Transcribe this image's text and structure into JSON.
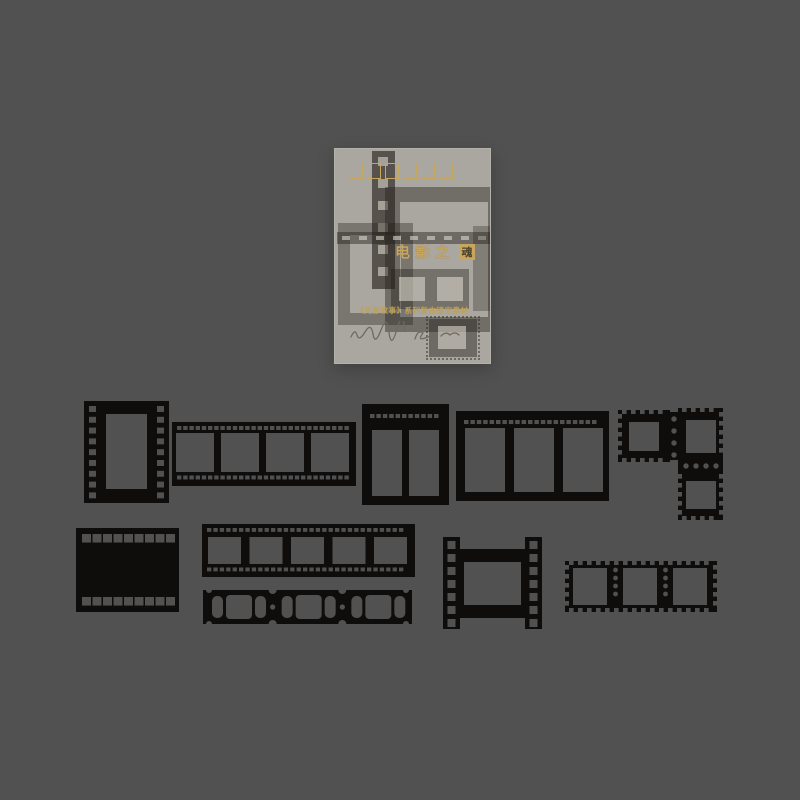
{
  "scene": {
    "background_color": "#515151",
    "ink_color": "#0f0d0b",
    "bag_color": "rgba(224,219,208,0.62)",
    "ghost_ink": "35,31,26",
    "ghost_window": "rgba(230,225,214,0.55)"
  },
  "package": {
    "title_prefix": "电影之",
    "seal_char": "魂",
    "subtitle": "《光影故事》系列复古镂空素材",
    "deco_square_count": 6,
    "gold_color": "#c8a65b",
    "seal_text_color": "#4a4030",
    "subtitle_color": "#bfa055",
    "signature_color": "#6e6a62",
    "ghosts": [
      {
        "kind": "strip-v",
        "x": 37,
        "y": 2,
        "w": 23,
        "h": 138,
        "a": 0.62,
        "holes": 6
      },
      {
        "kind": "frame",
        "x": 50,
        "y": 38,
        "w": 88,
        "h": 115,
        "b": 15,
        "a": 0.42
      },
      {
        "kind": "frame",
        "x": 3,
        "y": 74,
        "w": 51,
        "h": 78,
        "b": 12,
        "a": 0.36
      },
      {
        "kind": "band",
        "x": 2,
        "y": 83,
        "w": 153,
        "h": 12,
        "a": 0.45,
        "dashes": 9
      },
      {
        "kind": "solid",
        "x": 56,
        "y": 120,
        "w": 78,
        "h": 40,
        "a": 0.4,
        "wins": 2
      },
      {
        "kind": "solid",
        "x": 138,
        "y": 77,
        "w": 17,
        "h": 85,
        "a": 0.3,
        "wins": 0
      },
      {
        "kind": "stampghost",
        "x": 94,
        "y": 170,
        "w": 48,
        "h": 38,
        "a": 0.45
      }
    ]
  },
  "pieces": [
    {
      "id": "film-frame-vertical",
      "type": "vframe",
      "x": 84,
      "y": 401,
      "w": 85,
      "h": 102,
      "hole": [
        22,
        13,
        41,
        75
      ],
      "perf": {
        "count": 9,
        "size": 7,
        "inset": 5,
        "top": 5,
        "step": 10.8
      }
    },
    {
      "id": "filmstrip-4-frames",
      "type": "hstrip",
      "x": 172,
      "y": 422,
      "w": 184,
      "h": 64,
      "frames": {
        "count": 4,
        "ml": 4,
        "w": 38,
        "gap": 7,
        "top": 11,
        "h": 39
      },
      "perf": {
        "size": 4.4,
        "step": 6.2,
        "ml": 5,
        "topOff": 4,
        "botOff": 53.5
      }
    },
    {
      "id": "film-window-frame-2",
      "type": "windowframe",
      "x": 362,
      "y": 404,
      "w": 87,
      "h": 101,
      "windows": {
        "count": 2,
        "ml": 10,
        "w": 30,
        "gap": 7,
        "top": 26,
        "h": 66
      },
      "perf": {
        "size": 4.5,
        "step": 6.4,
        "ml": 8,
        "yOff": 10
      }
    },
    {
      "id": "film-window-frame-3",
      "type": "windowframe",
      "x": 456,
      "y": 411,
      "w": 153,
      "h": 90,
      "windows": {
        "count": 3,
        "ml": 9,
        "w": 40,
        "gap": 9,
        "top": 17,
        "h": 64
      },
      "perf": {
        "size": 4.5,
        "step": 6.4,
        "ml": 8,
        "yOff": 9
      }
    },
    {
      "id": "stamp-cluster",
      "type": "stampcluster",
      "stamps": [
        {
          "x": 618,
          "y": 410,
          "w": 52,
          "h": 52,
          "hole": [
            11,
            12,
            30,
            29
          ],
          "teeth": [
            "top",
            "left",
            "bottom"
          ]
        },
        {
          "x": 678,
          "y": 408,
          "w": 45,
          "h": 54,
          "hole": [
            8,
            12,
            30,
            33
          ],
          "teeth": [
            "top",
            "right"
          ]
        },
        {
          "x": 678,
          "y": 470,
          "w": 45,
          "h": 50,
          "hole": [
            8,
            11,
            30,
            28
          ],
          "teeth": [
            "left",
            "right",
            "bottom"
          ]
        }
      ],
      "bridges": [
        {
          "x": 670,
          "y": 412,
          "w": 8,
          "h": 48,
          "dots": {
            "x": 674,
            "y": 419,
            "dx": 0,
            "dy": 12,
            "n": 4
          }
        },
        {
          "x": 678,
          "y": 462,
          "w": 45,
          "h": 8,
          "dots": {
            "x": 686,
            "y": 466,
            "dx": 10,
            "dy": 0,
            "n": 4
          }
        }
      ]
    },
    {
      "id": "film-frame-solid",
      "type": "solidframe",
      "x": 76,
      "y": 528,
      "w": 103,
      "h": 84,
      "rows": {
        "count": 9,
        "size": 9,
        "ml": 6,
        "step": 10.5,
        "topOff": 6,
        "botOff": 69
      }
    },
    {
      "id": "filmstrip-5-frames",
      "type": "hstrip",
      "x": 202,
      "y": 524,
      "w": 213,
      "h": 53,
      "frames": {
        "count": 5,
        "ml": 6,
        "w": 33,
        "gap": 8.5,
        "top": 13,
        "h": 27
      },
      "perf": {
        "size": 4.3,
        "step": 6.4,
        "ml": 5,
        "topOff": 4,
        "botOff": 43.5
      }
    },
    {
      "id": "ticket-strip",
      "type": "ticketstrip",
      "x": 203,
      "y": 590,
      "w": 209,
      "h": 34,
      "segs": 3
    },
    {
      "id": "film-frame-rails",
      "type": "railframe",
      "x": 443,
      "y": 537,
      "w": 99,
      "h": 92,
      "railW": 17,
      "barTop": 12,
      "barBot": 68,
      "barH": 13,
      "holes": {
        "count": 7,
        "size": 8,
        "top": 4,
        "step": 13
      }
    },
    {
      "id": "stamp-strip-3",
      "type": "stampstrip",
      "x": 565,
      "y": 561,
      "w": 152,
      "h": 51,
      "windows": {
        "count": 3,
        "ml": 8,
        "w": 34,
        "gap": 16,
        "top": 7,
        "h": 37
      },
      "dotCols": [
        615.5,
        665.5
      ],
      "dotRow": {
        "start": 9,
        "step": 8,
        "n": 4
      }
    }
  ]
}
